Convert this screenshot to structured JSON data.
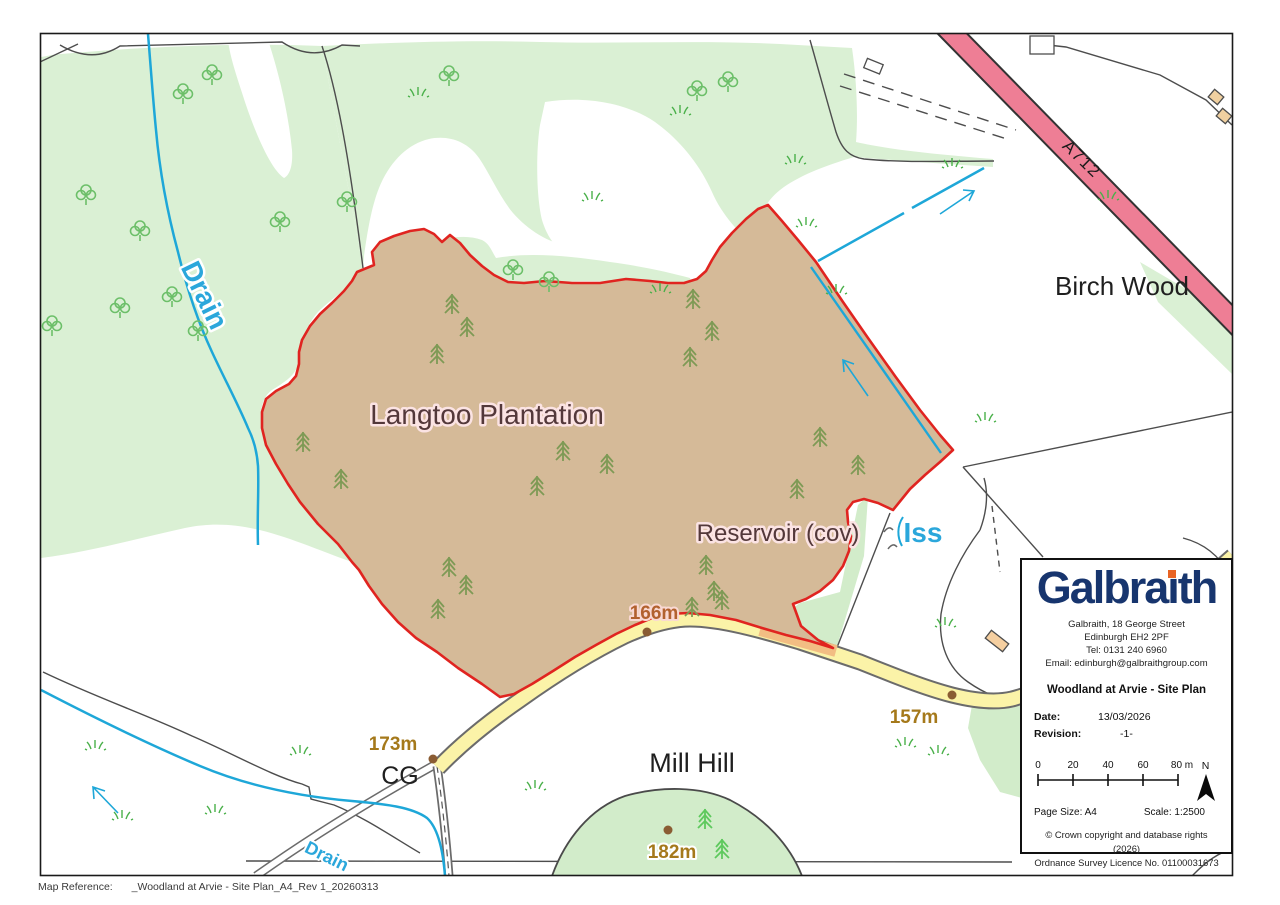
{
  "map": {
    "labels": {
      "plantation": "Langtoo Plantation",
      "reservoir": "Reservoir (cov)",
      "iss": "Iss",
      "drain": "Drain",
      "drain_lower": "Drain",
      "birch_wood": "Birch Wood",
      "mill_hill": "Mill Hill",
      "road_number": "A712",
      "cg": "CG",
      "spot_height_166": "166m",
      "spot_height_173": "173m",
      "spot_height_157": "157m",
      "spot_height_182": "182m"
    },
    "colors": {
      "site_fill": "#d5ba98",
      "site_boundary": "#e02420",
      "water": "#1ea7d8",
      "a_road": "#ee7e95",
      "minor_road": "#fbf3a8",
      "woodland": "#daf0d4",
      "hill": "#d2ecca",
      "spot_height_text": "#a5791b"
    }
  },
  "info_panel": {
    "logo": {
      "pre": "Galbra",
      "i": "ı",
      "post": "th"
    },
    "address_line1": "Galbraith, 18 George Street",
    "address_line2": "Edinburgh EH2 2PF",
    "address_line3": "Tel: 0131 240 6960",
    "address_line4": "Email: edinburgh@galbraithgroup.com",
    "title": "Woodland at Arvie - Site Plan",
    "date_label": "Date:",
    "date_value": "13/03/2026",
    "revision_label": "Revision:",
    "revision_value": "-1-",
    "scalebar": {
      "ticks": [
        "0",
        "20",
        "40",
        "60",
        "80 m"
      ],
      "north": "N"
    },
    "page_size": "Page Size: A4",
    "scale": "Scale: 1:2500",
    "copyright1": "© Crown copyright and database rights (2026)",
    "copyright2": "Ordnance Survey Licence No. 01100031673"
  },
  "footer": {
    "label": "Map Reference:",
    "value": "_Woodland at Arvie - Site Plan_A4_Rev 1_20260313"
  }
}
